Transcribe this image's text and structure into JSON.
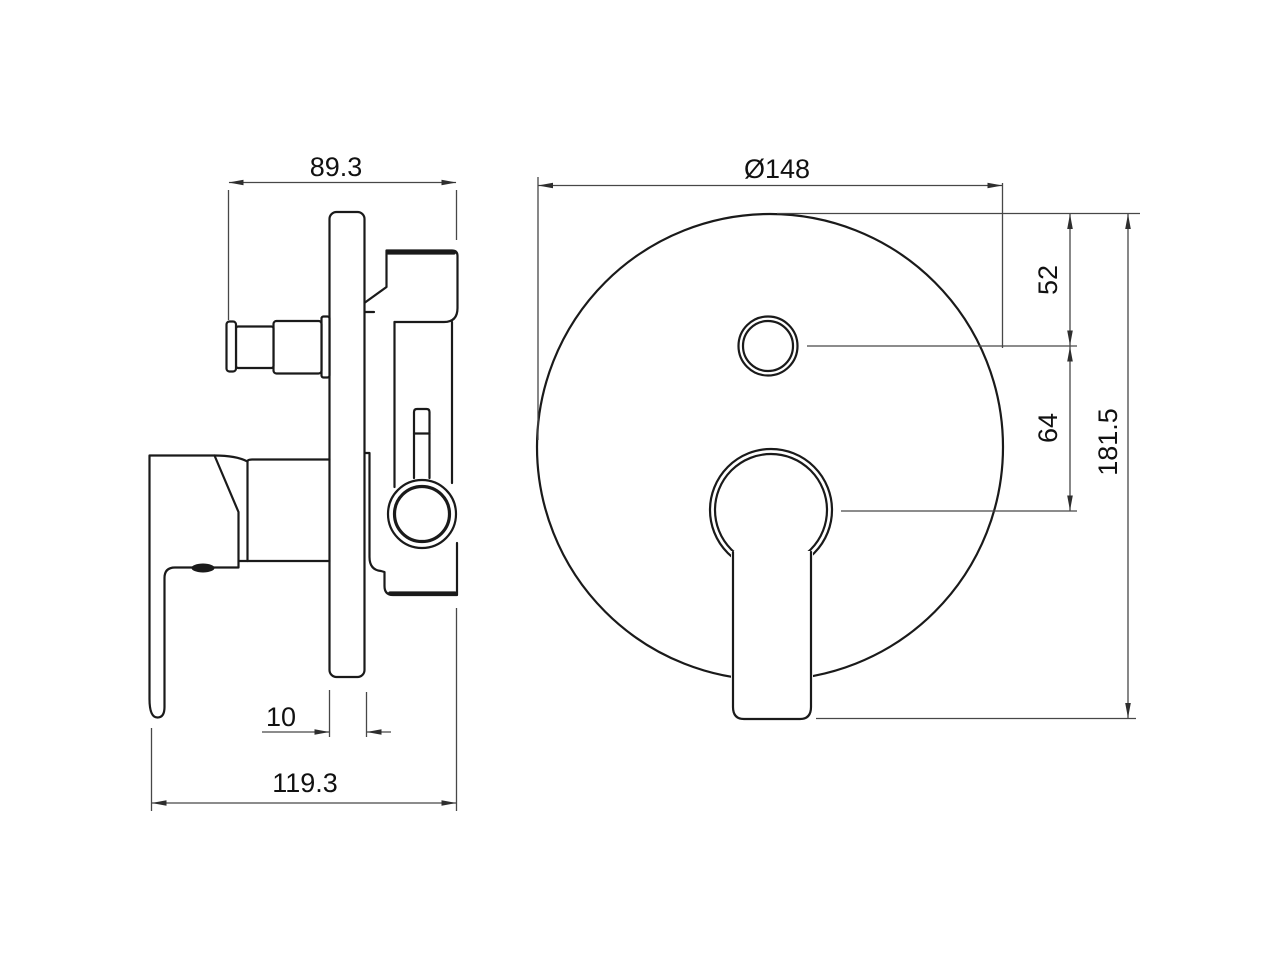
{
  "drawing": {
    "type": "technical-dimension-drawing",
    "subject": "concealed shower mixer valve, side view and front view",
    "colors": {
      "background": "#ffffff",
      "part_line": "#1a1a1a",
      "dimension_line": "#474747",
      "text": "#111111"
    },
    "dimensions": {
      "side_top_width": "89.3",
      "plate_thickness": "10",
      "side_total_depth": "119.3",
      "front_plate_diameter": "Ø148",
      "top_to_diverter": "52",
      "diverter_to_lever": "64",
      "front_total_height": "181.5"
    }
  }
}
